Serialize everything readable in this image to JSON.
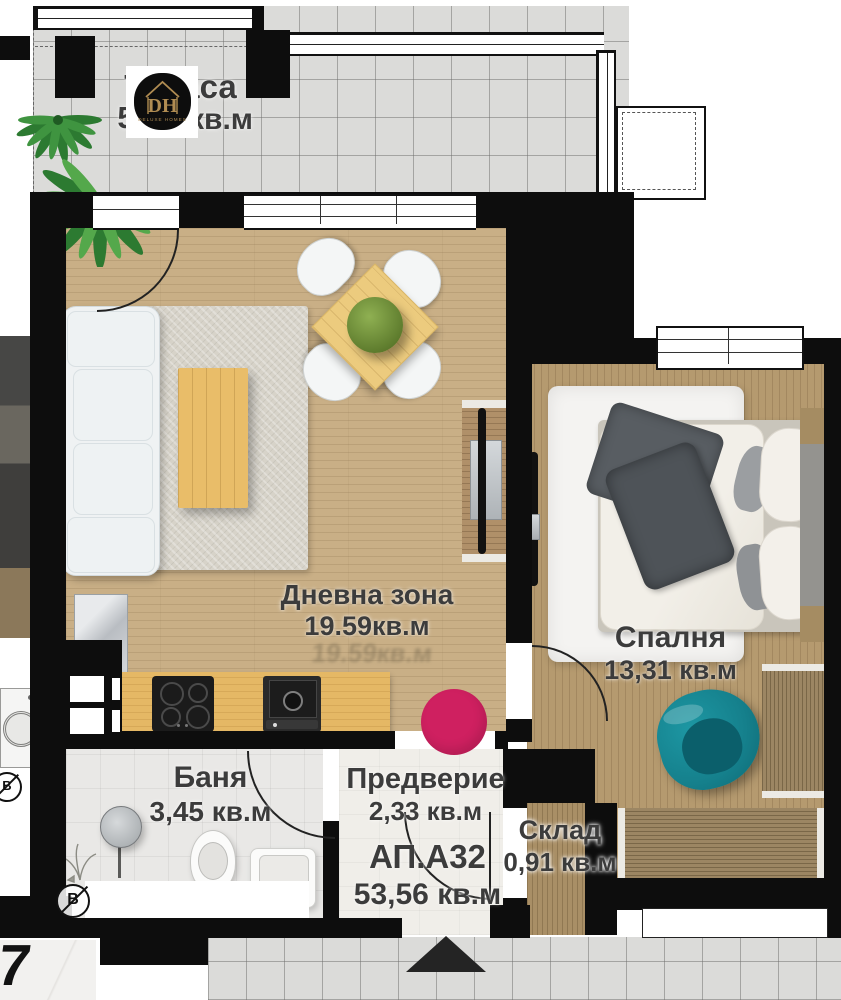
{
  "rooms": {
    "terrace": {
      "label": "Тераса",
      "area_prefix": "5",
      "area_suffix": "кв.м"
    },
    "living": {
      "label": "Дневна зона",
      "area": "19.59кв.м",
      "area_ghost": "19.59кв.м"
    },
    "bedroom": {
      "label": "Спалня",
      "area": "13,31 кв.м"
    },
    "bath": {
      "label": "Баня",
      "area": "3,45 кв.м"
    },
    "entry": {
      "label": "Предверие",
      "area": "2,33 кв.м"
    },
    "storage": {
      "label": "Склад",
      "area": "0,91 кв.м"
    }
  },
  "apartment": {
    "id": "АП.А32",
    "total_area": "53,56 кв.м"
  },
  "logo": {
    "initials": "DH",
    "name": "DELUXE HOMES"
  },
  "annotations": {
    "corner_digit": "7",
    "boiler_letter": "В"
  },
  "colors": {
    "wall": "#0d0d0d",
    "accent_pink": "#cf2060",
    "teal_chair": "#15808c",
    "living_floor": "#c9af86",
    "bedroom_floor": "#b59a6f",
    "kitchen_counter": "#e5b865",
    "terrace_tile": "#dbdbd9",
    "logo_gold": "#b08c52"
  }
}
